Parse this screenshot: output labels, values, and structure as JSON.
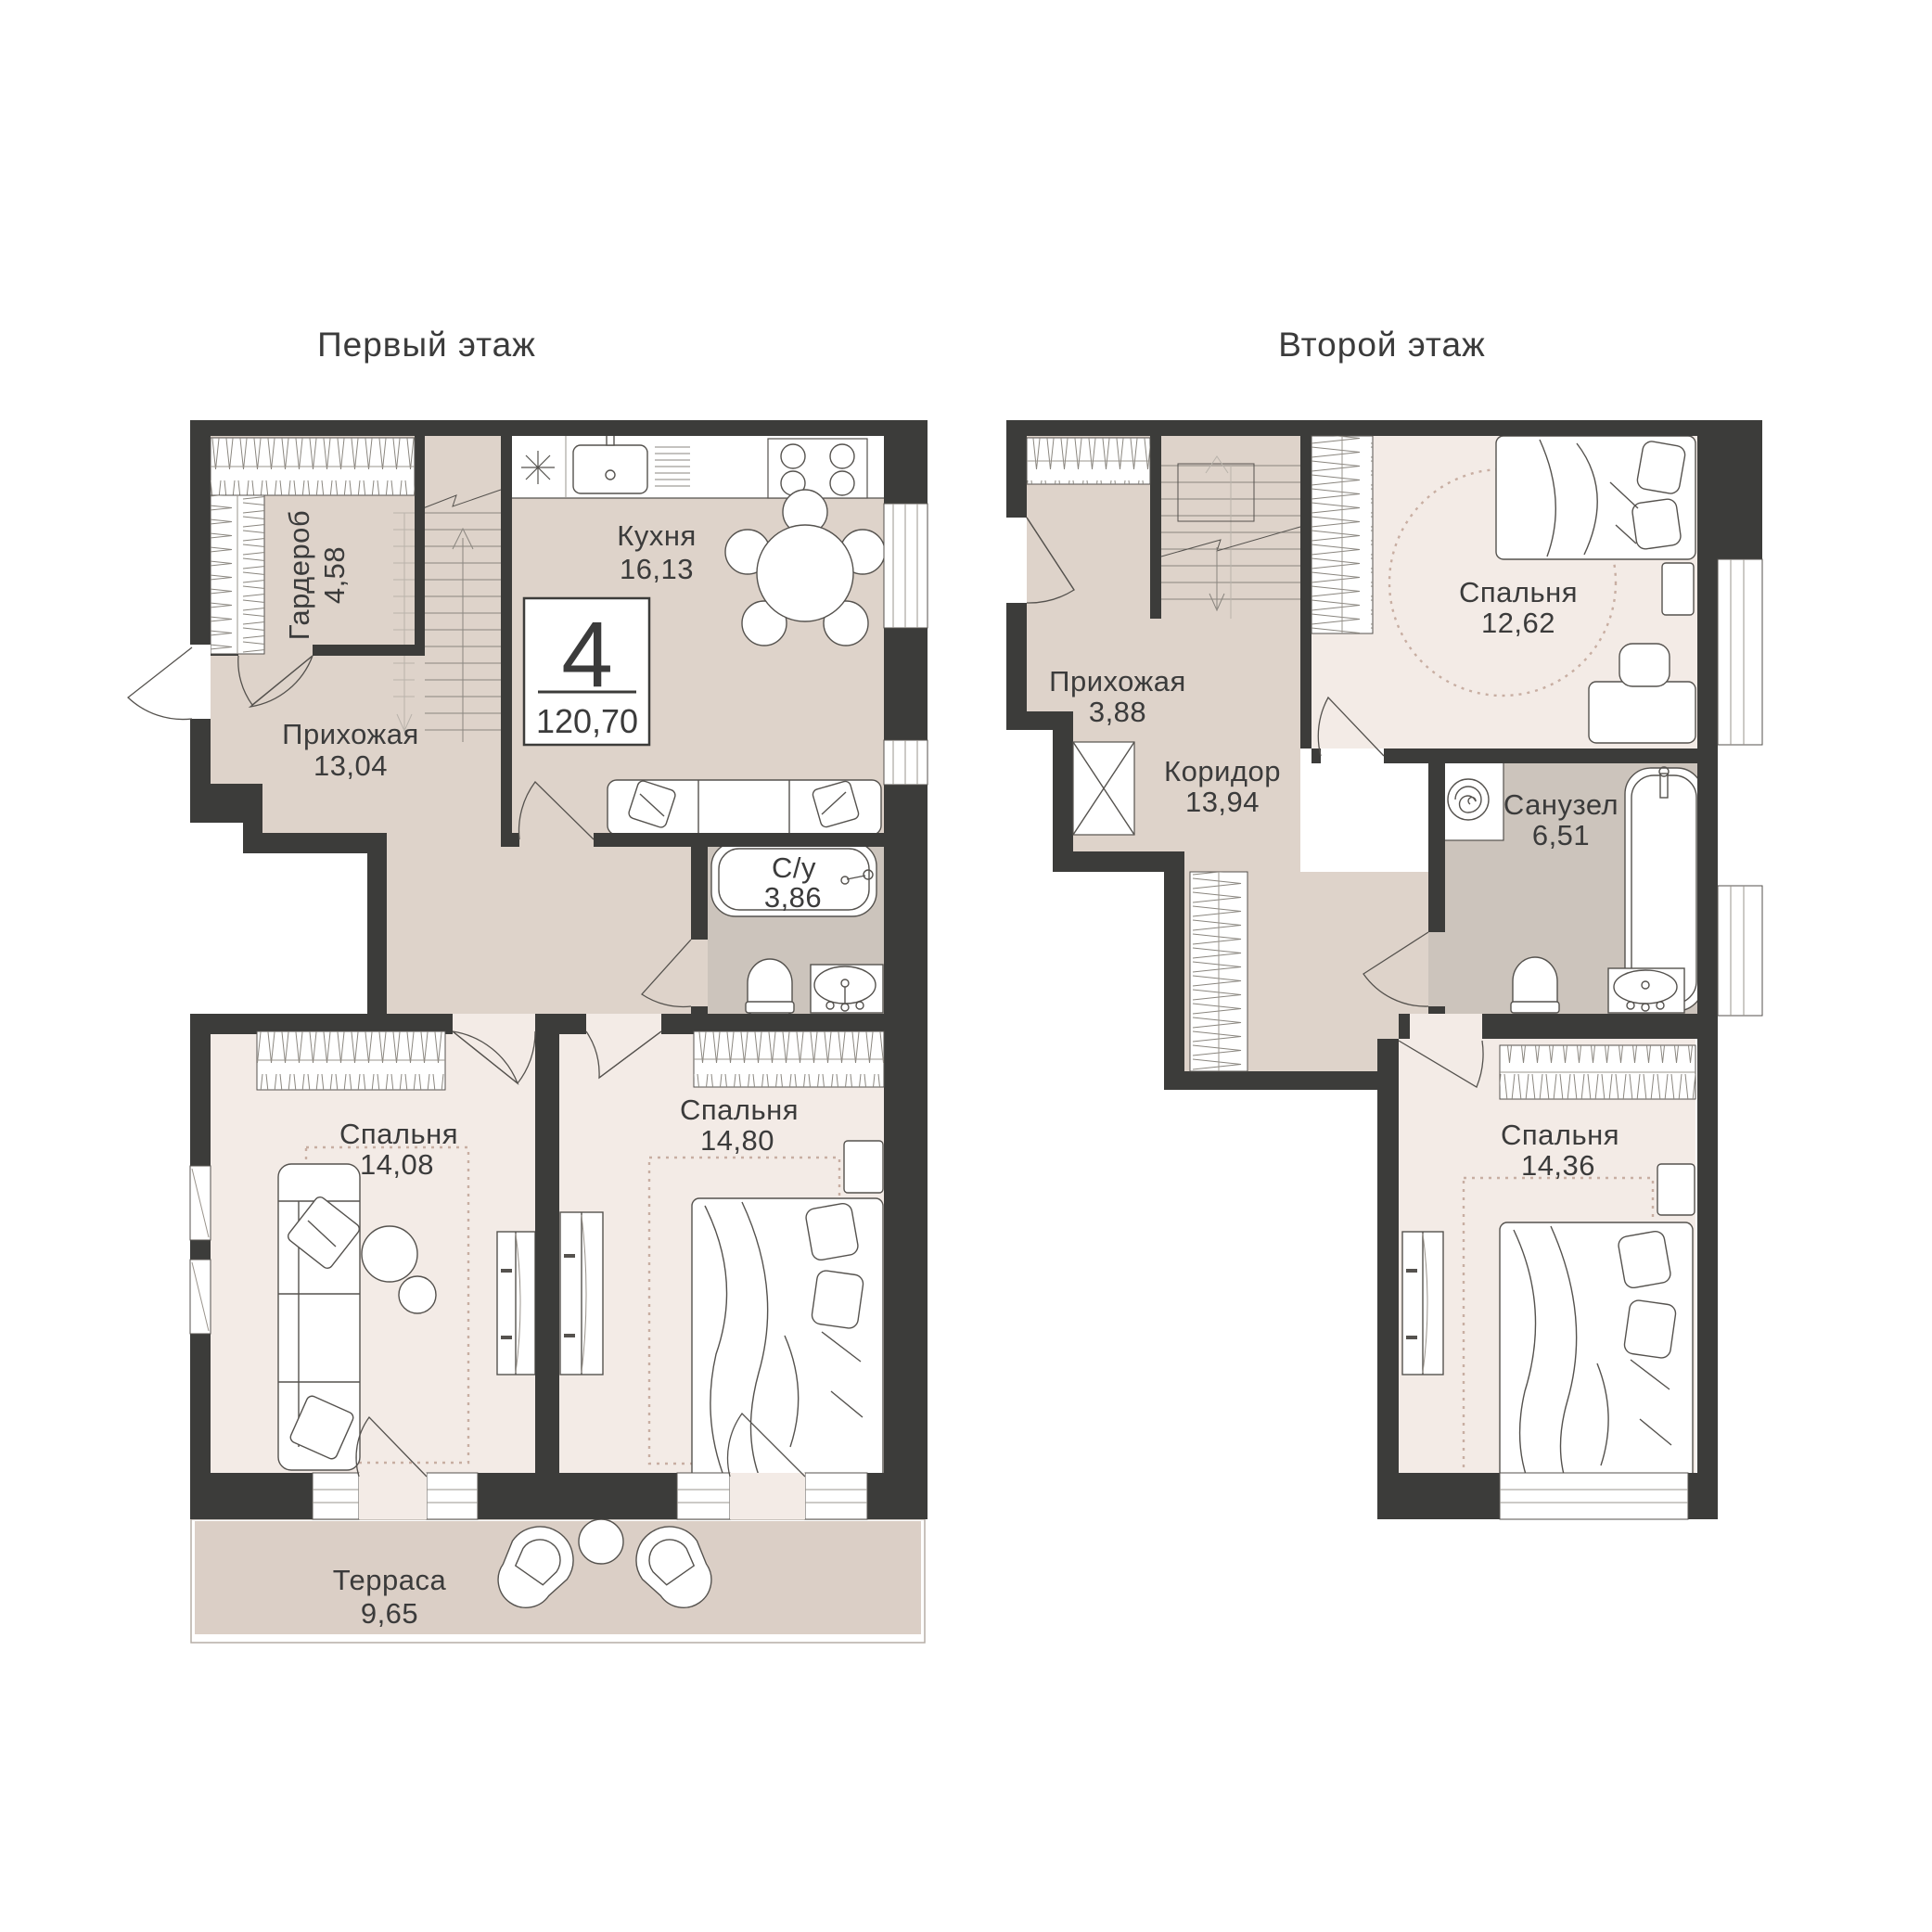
{
  "colors": {
    "wall": "#3C3C3A",
    "floor_tan": "#DED3CA",
    "floor_light": "#F3EBE6",
    "floor_bath": "#CCC4BC",
    "terrace": "#DBCFC6",
    "outline": "#55524E",
    "text": "#3B3B3B",
    "rug": "#C8AEA2",
    "background": "#FFFFFF"
  },
  "floor1": {
    "title": "Первый этаж",
    "badge": {
      "rooms_count": "4",
      "total_area": "120,70"
    },
    "rooms": [
      {
        "name": "Гардероб",
        "area": "4,58"
      },
      {
        "name": "Кухня",
        "area": "16,13"
      },
      {
        "name": "Прихожая",
        "area": "13,04"
      },
      {
        "name": "С/у",
        "area": "3,86"
      },
      {
        "name": "Спальня",
        "area": "14,08"
      },
      {
        "name": "Спальня",
        "area": "14,80"
      },
      {
        "name": "Терраса",
        "area": "9,65"
      }
    ]
  },
  "floor2": {
    "title": "Второй этаж",
    "rooms": [
      {
        "name": "Прихожая",
        "area": "3,88"
      },
      {
        "name": "Коридор",
        "area": "13,94"
      },
      {
        "name": "Спальня",
        "area": "12,62"
      },
      {
        "name": "Санузел",
        "area": "6,51"
      },
      {
        "name": "Спальня",
        "area": "14,36"
      }
    ]
  }
}
